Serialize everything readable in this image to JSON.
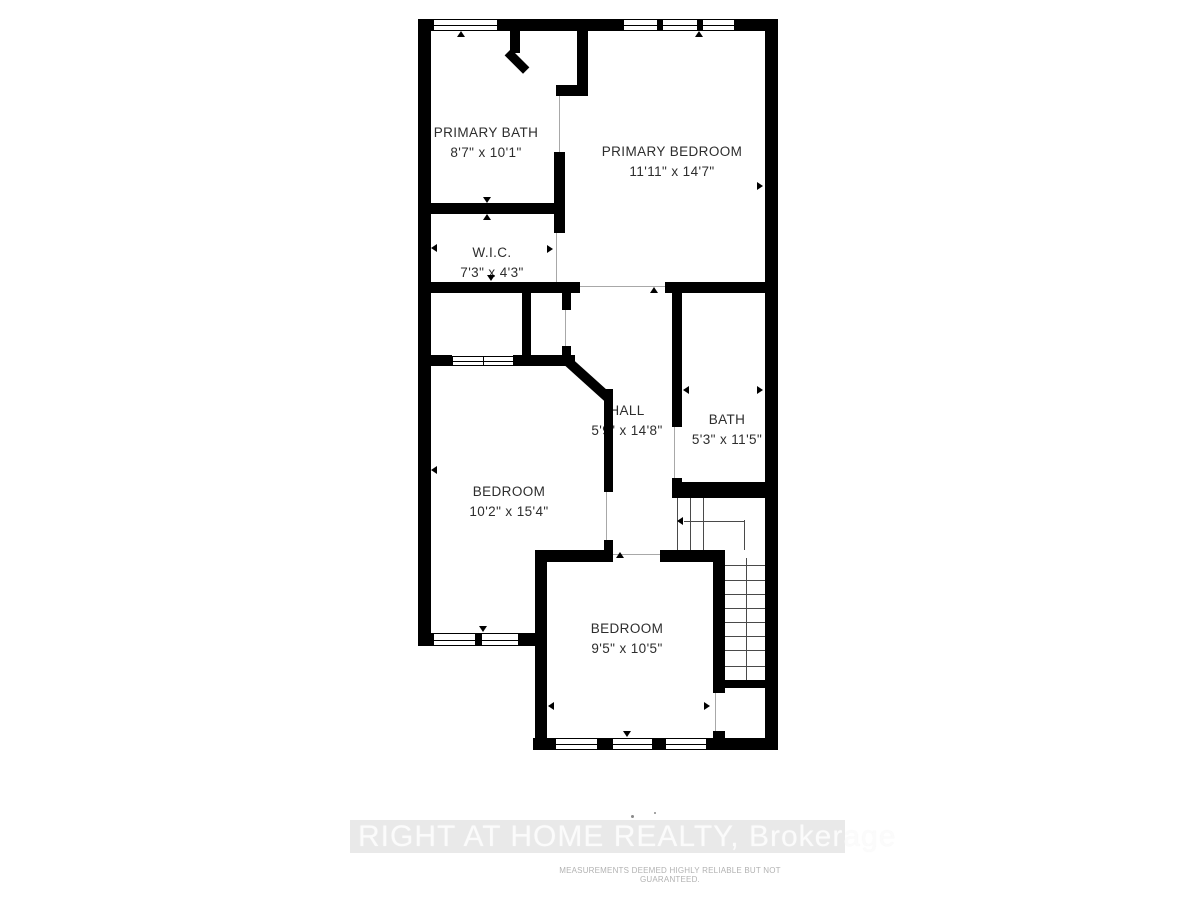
{
  "rooms": [
    {
      "id": "primary-bath",
      "name": "PRIMARY BATH",
      "dims": "8'7\" x 10'1\""
    },
    {
      "id": "primary-bedroom",
      "name": "PRIMARY BEDROOM",
      "dims": "11'11\" x 14'7\""
    },
    {
      "id": "wic",
      "name": "W.I.C.",
      "dims": "7'3\" x 4'3\""
    },
    {
      "id": "hall",
      "name": "HALL",
      "dims": "5'9\" x 14'8\""
    },
    {
      "id": "bath",
      "name": "BATH",
      "dims": "5'3\" x 11'5\""
    },
    {
      "id": "bedroom-left",
      "name": "BEDROOM",
      "dims": "10'2\" x 15'4\""
    },
    {
      "id": "bedroom-bottom",
      "name": "BEDROOM",
      "dims": "9'5\" x 10'5\""
    }
  ],
  "watermark": {
    "brand": "RIGHT AT HOME REALTY, Brokerage",
    "disclaimer": "MEASUREMENTS DEEMED HIGHLY RELIABLE BUT NOT GUARANTEED."
  },
  "colors": {
    "wall": "#000000",
    "label_text": "#2d2d2d",
    "watermark_band": "#e9e9e9",
    "watermark_text": "#fbfbfb",
    "disclaimer_text": "#b2b2b2"
  }
}
